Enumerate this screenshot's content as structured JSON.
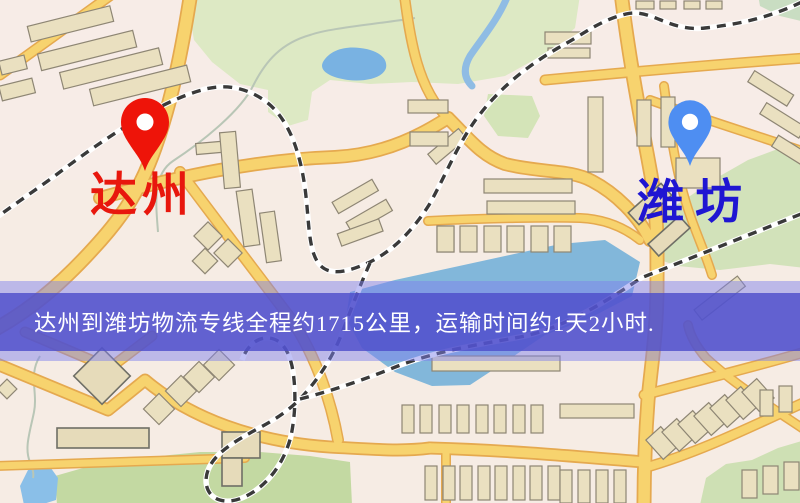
{
  "map": {
    "origin_marker": {
      "label": "达州",
      "pin_color": "#ee1409",
      "label_color": "#e8170d"
    },
    "destination_marker": {
      "label": "潍坊",
      "pin_color": "#4e8ef2",
      "label_color": "#1f16d2"
    },
    "banner": {
      "text": "达州到潍坊物流专线全程约1715公里，运输时间约1天2小时.",
      "text_color": "#ffffff",
      "inner_band_color": "rgba(78,78,202,0.82)",
      "outer_band_color": "rgba(125,128,236,0.48)"
    },
    "colors": {
      "base": "#f6ece4",
      "road_fill": "#f7d36e",
      "road_casing": "#e5a94f",
      "building_fill": "#eae0c0",
      "building_stroke": "#8e8674",
      "park_green": "#d8e6bc",
      "park_green_dark": "#c3d9a2",
      "water_blue": "#82b7da",
      "pond_blue": "#79b2e2",
      "railway_dark": "#3a3a3a"
    }
  }
}
